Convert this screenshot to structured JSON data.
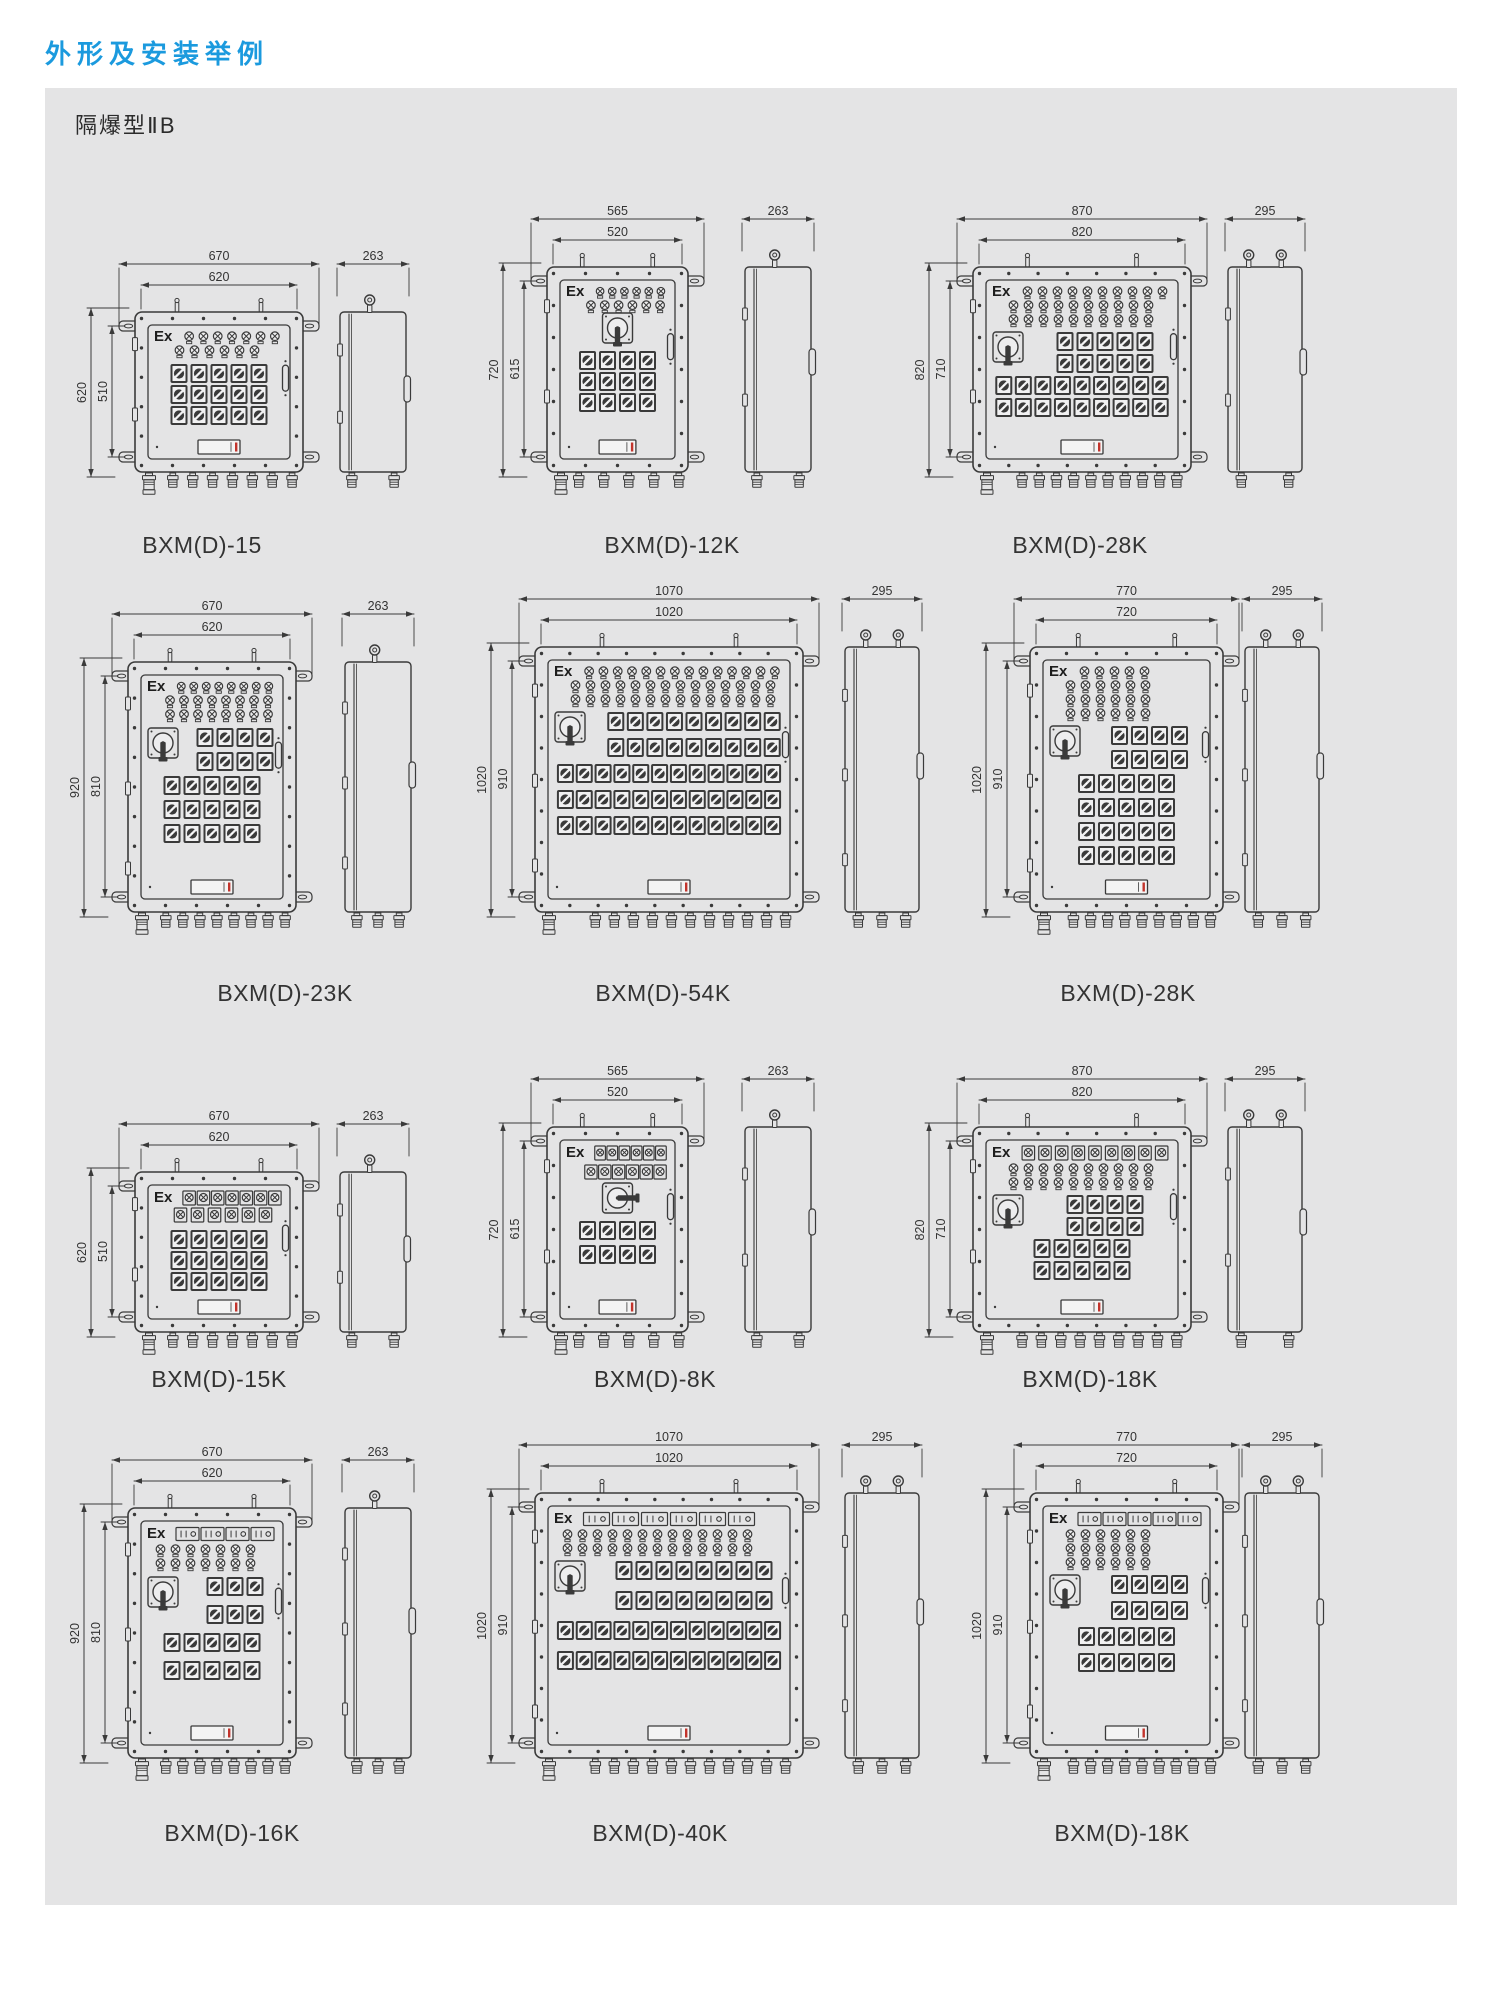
{
  "page": {
    "title": "外形及安装举例",
    "subtitle": "隔爆型ⅡB",
    "ex_label": "Ex",
    "title_color": "#1b9ade",
    "panel_bg": "#e4e4e5",
    "line_color": "#3a3a3a",
    "accent_red": "#c2342c"
  },
  "drawings": [
    {
      "label": "BXM(D)-15",
      "dims": {
        "w_outer": "670",
        "w_inner": "620",
        "h_outer": "620",
        "h_inner": "510",
        "side": "263"
      },
      "pos": {
        "x": 135,
        "top": 312,
        "w": 168,
        "h": 160,
        "side_x": 340,
        "side_w": 66,
        "label_cx": 202,
        "label_y": 532
      },
      "eyebolts": 1,
      "glands": 8,
      "side_glands": 2,
      "swh": 21,
      "rows": [
        {
          "t": "lamp",
          "n": 7,
          "ex": 1
        },
        {
          "t": "lamp",
          "n": 6,
          "ind": 16
        },
        {
          "t": "gap",
          "h": 6
        },
        {
          "t": "sw",
          "n": 5
        },
        {
          "t": "sw",
          "n": 5
        },
        {
          "t": "sw",
          "n": 5
        }
      ]
    },
    {
      "label": "BXM(D)-12K",
      "dims": {
        "w_outer": "565",
        "w_inner": "520",
        "h_outer": "720",
        "h_inner": "615",
        "side": "263"
      },
      "pos": {
        "x": 547,
        "top": 267,
        "w": 141,
        "h": 205,
        "side_x": 745,
        "side_w": 66,
        "label_cx": 672,
        "label_y": 532
      },
      "eyebolts": 1,
      "glands": 6,
      "side_glands": 2,
      "swh": 21,
      "rows": [
        {
          "t": "lamp",
          "n": 6,
          "ex": 1
        },
        {
          "t": "lamp",
          "n": 6,
          "ind": 16
        },
        {
          "t": "main",
          "bar": "v"
        },
        {
          "t": "sw",
          "n": 4
        },
        {
          "t": "sw",
          "n": 4
        },
        {
          "t": "sw",
          "n": 4
        }
      ]
    },
    {
      "label": "BXM(D)-28K",
      "dims": {
        "w_outer": "870",
        "w_inner": "820",
        "h_outer": "820",
        "h_inner": "710",
        "side": "295"
      },
      "pos": {
        "x": 973,
        "top": 267,
        "w": 218,
        "h": 205,
        "side_x": 1228,
        "side_w": 74,
        "label_cx": 1080,
        "label_y": 532
      },
      "eyebolts": 2,
      "glands": 11,
      "side_glands": 2,
      "swh": 22,
      "rows": [
        {
          "t": "lamp",
          "n": 10,
          "ex": 1
        },
        {
          "t": "lamp",
          "n": 10,
          "ind": 12
        },
        {
          "t": "lamp",
          "n": 10,
          "ind": 12
        },
        {
          "t": "gap",
          "h": 5
        },
        {
          "t": "sw",
          "n": 5,
          "m": 1,
          "ind": 46
        },
        {
          "t": "sw",
          "n": 5,
          "ind": 46
        },
        {
          "t": "sw",
          "n": 9
        },
        {
          "t": "sw",
          "n": 9
        }
      ]
    },
    {
      "label": "BXM(D)-23K",
      "dims": {
        "w_outer": "670",
        "w_inner": "620",
        "h_outer": "920",
        "h_inner": "810",
        "side": "263"
      },
      "pos": {
        "x": 128,
        "top": 662,
        "w": 168,
        "h": 250,
        "side_x": 345,
        "side_w": 66,
        "label_cx": 285,
        "label_y": 980
      },
      "eyebolts": 1,
      "glands": 9,
      "side_glands": 3,
      "swh": 24,
      "rows": [
        {
          "t": "lamp",
          "n": 8,
          "ex": 1
        },
        {
          "t": "lamp",
          "n": 8,
          "ind": 14
        },
        {
          "t": "lamp",
          "n": 8,
          "ind": 14
        },
        {
          "t": "gap",
          "h": 6
        },
        {
          "t": "sw",
          "n": 4,
          "m": 1,
          "ind": 46
        },
        {
          "t": "sw",
          "n": 4,
          "ind": 46
        },
        {
          "t": "sw",
          "n": 5
        },
        {
          "t": "sw",
          "n": 5
        },
        {
          "t": "sw",
          "n": 5
        }
      ]
    },
    {
      "label": "BXM(D)-54K",
      "dims": {
        "w_outer": "1070",
        "w_inner": "1020",
        "h_outer": "1020",
        "h_inner": "910",
        "side": "295"
      },
      "pos": {
        "x": 535,
        "top": 647,
        "w": 268,
        "h": 265,
        "side_x": 845,
        "side_w": 74,
        "label_cx": 663,
        "label_y": 980
      },
      "eyebolts": 2,
      "glands": 12,
      "side_glands": 3,
      "swh": 26,
      "rows": [
        {
          "t": "lamp",
          "n": 14,
          "ex": 1
        },
        {
          "t": "lamp",
          "n": 14,
          "ind": 12
        },
        {
          "t": "lamp",
          "n": 14,
          "ind": 12
        },
        {
          "t": "gap",
          "h": 5
        },
        {
          "t": "sw",
          "n": 9,
          "m": 1,
          "ind": 50
        },
        {
          "t": "sw",
          "n": 9,
          "ind": 50
        },
        {
          "t": "sw",
          "n": 12
        },
        {
          "t": "sw",
          "n": 12
        },
        {
          "t": "sw",
          "n": 12
        }
      ]
    },
    {
      "label": "BXM(D)-28K",
      "dims": {
        "w_outer": "770",
        "w_inner": "720",
        "h_outer": "1020",
        "h_inner": "910",
        "side": "295"
      },
      "pos": {
        "x": 1030,
        "top": 647,
        "w": 193,
        "h": 265,
        "side_x": 1245,
        "side_w": 74,
        "label_cx": 1128,
        "label_y": 980
      },
      "eyebolts": 2,
      "glands": 10,
      "side_glands": 3,
      "swh": 24,
      "rows": [
        {
          "t": "lamp",
          "n": 5,
          "ex": 1
        },
        {
          "t": "lamp",
          "n": 6,
          "ind": 12
        },
        {
          "t": "lamp",
          "n": 6,
          "ind": 12
        },
        {
          "t": "lamp",
          "n": 6,
          "ind": 12
        },
        {
          "t": "gap",
          "h": 5
        },
        {
          "t": "sw",
          "n": 4,
          "m": 1,
          "ind": 46
        },
        {
          "t": "sw",
          "n": 4,
          "ind": 46
        },
        {
          "t": "sw",
          "n": 5
        },
        {
          "t": "sw",
          "n": 5
        },
        {
          "t": "sw",
          "n": 5
        },
        {
          "t": "sw",
          "n": 5
        }
      ]
    },
    {
      "label": "BXM(D)-15K",
      "dims": {
        "w_outer": "670",
        "w_inner": "620",
        "h_outer": "620",
        "h_inner": "510",
        "side": "263"
      },
      "pos": {
        "x": 135,
        "top": 1172,
        "w": 168,
        "h": 160,
        "side_x": 340,
        "side_w": 66,
        "label_cx": 219,
        "label_y": 1366
      },
      "eyebolts": 1,
      "glands": 8,
      "side_glands": 2,
      "swh": 21,
      "mh": 17,
      "rows": [
        {
          "t": "meter",
          "n": 7,
          "ex": 1
        },
        {
          "t": "meter",
          "n": 6,
          "ind": 16
        },
        {
          "t": "gap",
          "h": 6
        },
        {
          "t": "sw",
          "n": 5
        },
        {
          "t": "sw",
          "n": 5
        },
        {
          "t": "sw",
          "n": 5
        }
      ]
    },
    {
      "label": "BXM(D)-8K",
      "dims": {
        "w_outer": "565",
        "w_inner": "520",
        "h_outer": "720",
        "h_inner": "615",
        "side": "263"
      },
      "pos": {
        "x": 547,
        "top": 1127,
        "w": 141,
        "h": 205,
        "side_x": 745,
        "side_w": 66,
        "label_cx": 655,
        "label_y": 1366
      },
      "eyebolts": 1,
      "glands": 6,
      "side_glands": 2,
      "swh": 24,
      "mh": 19,
      "rows": [
        {
          "t": "meter",
          "n": 6,
          "ex": 1
        },
        {
          "t": "meter",
          "n": 6,
          "ind": 16
        },
        {
          "t": "main",
          "bar": "h"
        },
        {
          "t": "sw",
          "n": 4
        },
        {
          "t": "sw",
          "n": 4
        }
      ]
    },
    {
      "label": "BXM(D)-18K",
      "dims": {
        "w_outer": "870",
        "w_inner": "820",
        "h_outer": "820",
        "h_inner": "710",
        "side": "295"
      },
      "pos": {
        "x": 973,
        "top": 1127,
        "w": 218,
        "h": 205,
        "side_x": 1228,
        "side_w": 74,
        "label_cx": 1090,
        "label_y": 1366
      },
      "eyebolts": 2,
      "glands": 10,
      "side_glands": 2,
      "swh": 22,
      "mh": 17,
      "rows": [
        {
          "t": "meter",
          "n": 9,
          "ex": 1
        },
        {
          "t": "lamp",
          "n": 10,
          "ind": 12
        },
        {
          "t": "lamp",
          "n": 10,
          "ind": 12
        },
        {
          "t": "gap",
          "h": 5
        },
        {
          "t": "sw",
          "n": 4,
          "m": 1,
          "ind": 46
        },
        {
          "t": "sw",
          "n": 4,
          "ind": 46
        },
        {
          "t": "sw",
          "n": 5
        },
        {
          "t": "sw",
          "n": 5
        }
      ]
    },
    {
      "label": "BXM(D)-16K",
      "dims": {
        "w_outer": "670",
        "w_inner": "620",
        "h_outer": "920",
        "h_inner": "810",
        "side": "263"
      },
      "pos": {
        "x": 128,
        "top": 1508,
        "w": 168,
        "h": 250,
        "side_x": 345,
        "side_w": 66,
        "label_cx": 232,
        "label_y": 1820
      },
      "eyebolts": 1,
      "glands": 9,
      "side_glands": 3,
      "swh": 28,
      "rows": [
        {
          "t": "wmeter",
          "n": 4,
          "ex": 1
        },
        {
          "t": "lamp",
          "n": 7,
          "ind": 4
        },
        {
          "t": "lamp",
          "n": 7,
          "ind": 4
        },
        {
          "t": "gap",
          "h": 6
        },
        {
          "t": "sw",
          "n": 3,
          "m": 1,
          "ind": 46
        },
        {
          "t": "sw",
          "n": 3,
          "ind": 46
        },
        {
          "t": "sw",
          "n": 5
        },
        {
          "t": "sw",
          "n": 5
        }
      ]
    },
    {
      "label": "BXM(D)-40K",
      "dims": {
        "w_outer": "1070",
        "w_inner": "1020",
        "h_outer": "1020",
        "h_inner": "910",
        "side": "295"
      },
      "pos": {
        "x": 535,
        "top": 1493,
        "w": 268,
        "h": 265,
        "side_x": 845,
        "side_w": 74,
        "label_cx": 660,
        "label_y": 1820
      },
      "eyebolts": 2,
      "glands": 12,
      "side_glands": 3,
      "swh": 30,
      "rows": [
        {
          "t": "wmeter",
          "n": 6,
          "ex": 1
        },
        {
          "t": "lamp",
          "n": 13,
          "ind": 4
        },
        {
          "t": "lamp",
          "n": 13,
          "ind": 4
        },
        {
          "t": "gap",
          "h": 5
        },
        {
          "t": "sw",
          "n": 8,
          "m": 1,
          "ind": 50
        },
        {
          "t": "sw",
          "n": 8,
          "ind": 50
        },
        {
          "t": "sw",
          "n": 12
        },
        {
          "t": "sw",
          "n": 12
        }
      ]
    },
    {
      "label": "BXM(D)-18K",
      "dims": {
        "w_outer": "770",
        "w_inner": "720",
        "h_outer": "1020",
        "h_inner": "910",
        "side": "295"
      },
      "pos": {
        "x": 1030,
        "top": 1493,
        "w": 193,
        "h": 265,
        "side_x": 1245,
        "side_w": 74,
        "label_cx": 1122,
        "label_y": 1820
      },
      "eyebolts": 2,
      "glands": 10,
      "side_glands": 3,
      "swh": 26,
      "rows": [
        {
          "t": "wmeter",
          "n": 5,
          "ex": 1
        },
        {
          "t": "lamp",
          "n": 6,
          "ind": 12
        },
        {
          "t": "lamp",
          "n": 6,
          "ind": 12
        },
        {
          "t": "lamp",
          "n": 6,
          "ind": 12
        },
        {
          "t": "gap",
          "h": 5
        },
        {
          "t": "sw",
          "n": 4,
          "m": 1,
          "ind": 46
        },
        {
          "t": "sw",
          "n": 4,
          "ind": 46
        },
        {
          "t": "sw",
          "n": 5
        },
        {
          "t": "sw",
          "n": 5
        }
      ]
    }
  ]
}
